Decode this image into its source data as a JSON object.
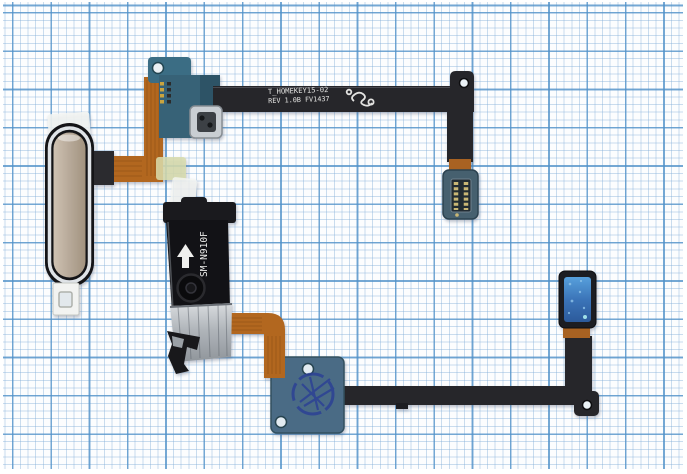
{
  "scene": {
    "description": "Two smartphone home-button fingerprint sensor flex cable assemblies lying on blue graph paper",
    "upper_flex_markings": {
      "line1": "T_HOMEKEY15-02",
      "line2": "REV 1.0B FV1437"
    },
    "lower_bracket_marking": "SM-N910F",
    "colors": {
      "paper": "#fcfdfe",
      "grid_major": "#5091c8",
      "grid_minor": "#7daad7",
      "flex_black": "#26262a",
      "flex_copper": "#b2671f",
      "pcb_green": "#3a6b82",
      "pcb_blue": "#4a6b85",
      "connector_blue": "#3f7ec2",
      "stamp_ink": "#2a3f96",
      "button_gold": "#b9ab9c",
      "button_ring": "#dfe3e7",
      "button_rim": "#141417",
      "bracket_metal": "#b4b9be"
    }
  }
}
